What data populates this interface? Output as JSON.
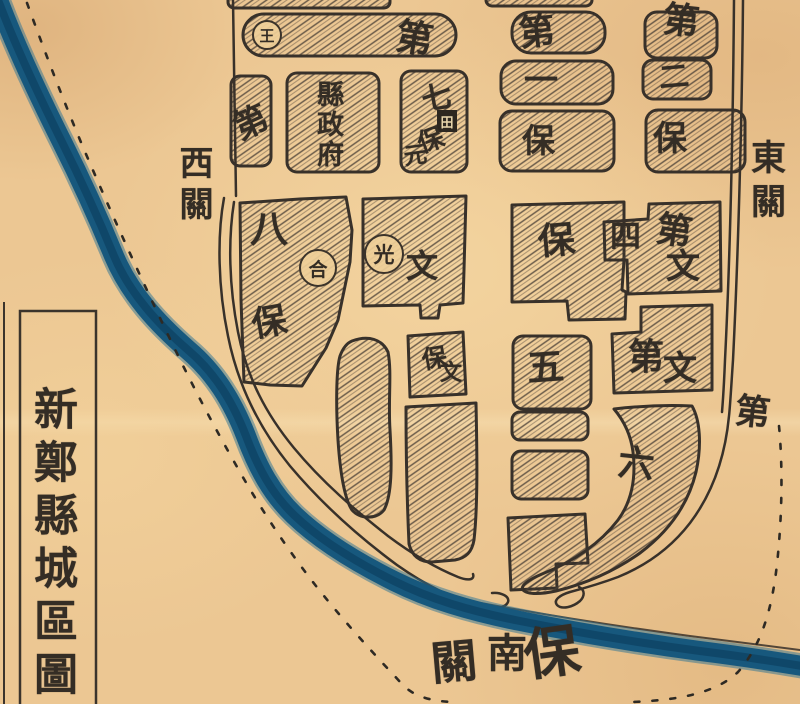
{
  "title": "新鄭縣城區圖",
  "colors": {
    "paper": "#ecc793",
    "ink": "#38312a",
    "hatch": "#4a4036",
    "river": "#17587d",
    "river_dark": "#0d4061"
  },
  "gates": {
    "west": "西關",
    "east": "東關",
    "south": {
      "guan": "關",
      "nan": "南",
      "bao": "保"
    }
  },
  "suburb": {
    "bar_di": "第",
    "circle_wang": "王",
    "di_block": "第",
    "county_government": "縣政府",
    "ward7": {
      "qi": "七",
      "square_tian": "田",
      "bao": "保",
      "yuan": "元"
    }
  },
  "ward1": {
    "di": "第",
    "num": "一",
    "bao": "保"
  },
  "ward2": {
    "di": "第",
    "num": "二",
    "bao": "保"
  },
  "ward8": {
    "num": "八",
    "circle_he": "合",
    "bao": "保"
  },
  "wenguang": {
    "circle_guang": "光",
    "wen": "文"
  },
  "baowen": {
    "bao": "保",
    "wen": "文"
  },
  "ward4": {
    "bao": "保",
    "num": "四",
    "di": "第",
    "wen": "文"
  },
  "ward5": {
    "di": "第",
    "wen": "文",
    "num": "五"
  },
  "ward6": {
    "num": "六",
    "di": "第"
  }
}
